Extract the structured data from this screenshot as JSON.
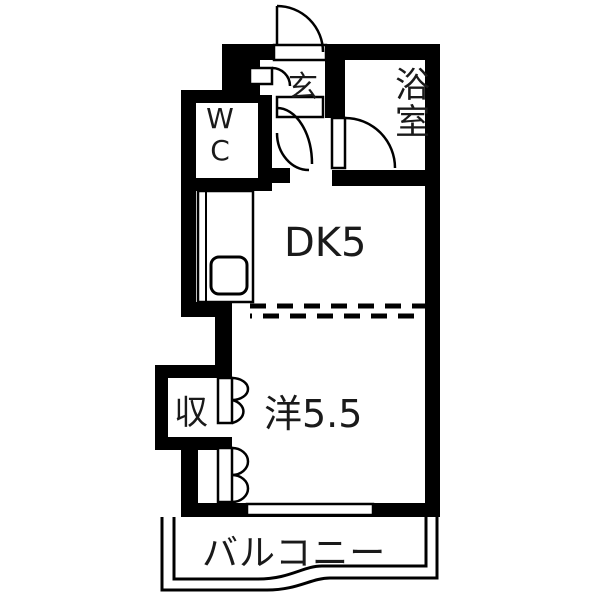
{
  "floorplan": {
    "title": "1DK apartment floor plan",
    "rooms": {
      "entrance": {
        "label": "玄"
      },
      "bathroom": {
        "label": "浴室"
      },
      "toilet": {
        "label": "WC"
      },
      "dining_kitchen": {
        "label": "DK5"
      },
      "storage": {
        "label": "収"
      },
      "western_room": {
        "label": "洋5.5"
      },
      "balcony": {
        "label": "バルコニー"
      }
    },
    "colors": {
      "wall": "#000000",
      "background": "#ffffff",
      "text": "#1a1a1a"
    }
  }
}
